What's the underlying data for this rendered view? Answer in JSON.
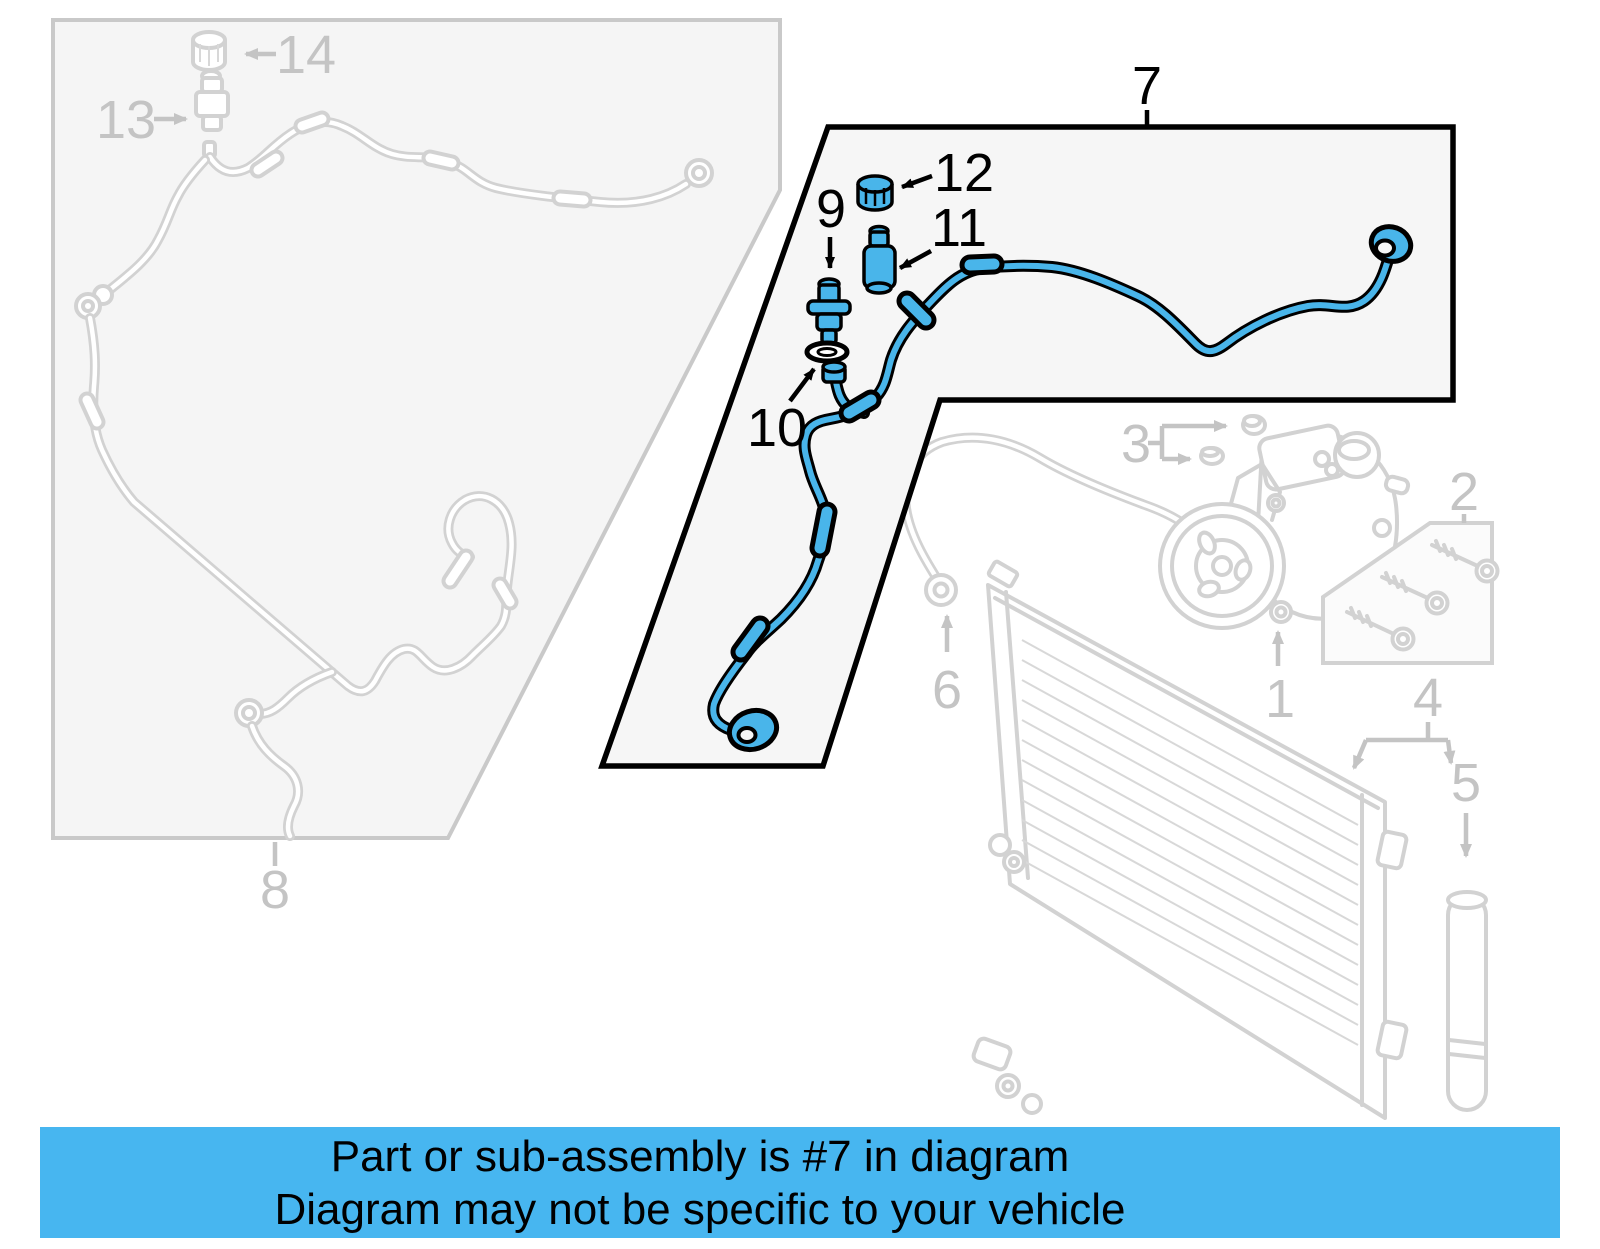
{
  "diagram": {
    "description": "Air conditioning parts diagram",
    "highlighted_callout": "7",
    "callouts": {
      "c1": "1",
      "c2": "2",
      "c3": "3",
      "c4": "4",
      "c5": "5",
      "c6": "6",
      "c7": "7",
      "c8": "8",
      "c9": "9",
      "c10": "10",
      "c11": "11",
      "c12": "12",
      "c13": "13",
      "c14": "14"
    }
  },
  "banner": {
    "line1": "Part or sub-assembly is #7 in diagram",
    "line2": "Diagram may not be specific to your vehicle"
  },
  "colors": {
    "highlight_blue": "#49b5ea",
    "banner_blue": "#47b6f0",
    "outline_black": "#000000",
    "faded_gray": "#d2d2d2",
    "label_gray": "#c4c4c4"
  }
}
